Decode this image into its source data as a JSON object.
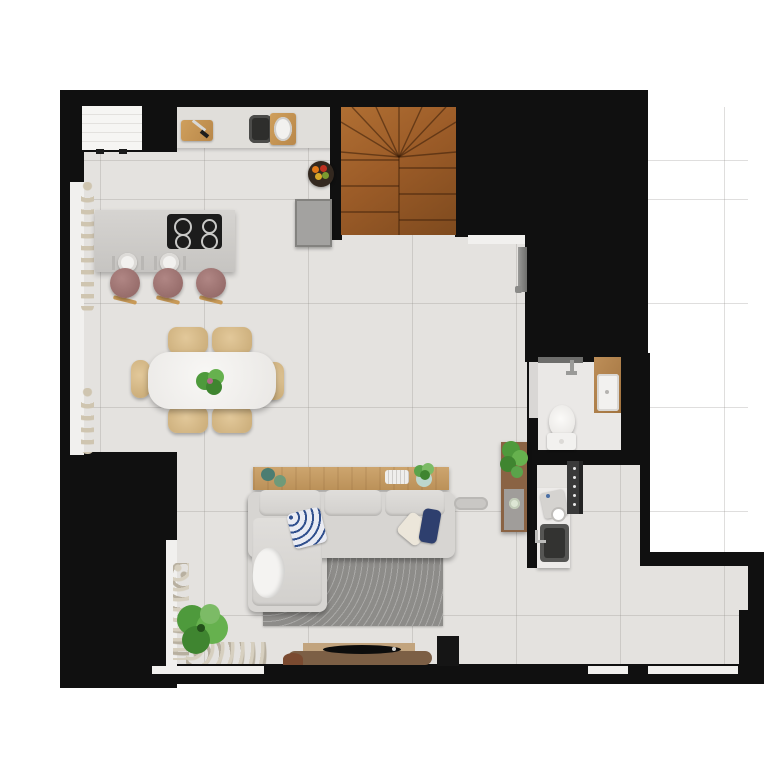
{
  "title": "apartment-floor-plan-top-view",
  "palette": {
    "bg": "#ffffff",
    "wall": "#101010",
    "floor": "#e4e2df",
    "floorBath": "#eae8e6",
    "doorGap": "#d9d7d5",
    "counter": "#e0deda",
    "sill": "#f1f0ee",
    "curtain": "#cfc5b0",
    "brick": "#f6f5f3",
    "cooktop": "#1c1c1c",
    "appliance": "#a3a2a0",
    "basin": "#f2f1ef",
    "sofa": "#d7d5d2",
    "rug": "#8d8c89",
    "pillowBlue": "#31508e",
    "pillowNavy": "#2e3f6e",
    "pebble": "#d6cfbf",
    "woodDark": "#7c5f45",
    "woodSide": "#8a6344",
    "accentBlue": "#4a6fa5",
    "stairsLight": "#b06f33",
    "stairsDark": "#7e4a1e",
    "plantGreen": "#55a143",
    "chairTan": "#d8bc8c",
    "stoolMauve": "#9e7170"
  },
  "scene": {
    "rooms": [
      "kitchen",
      "dining-area",
      "living-room",
      "staircase",
      "bathroom",
      "kitchenette-nook",
      "entry-floor"
    ],
    "kitchen": {
      "items": [
        "white-brick-panel",
        "cutting-board-with-knife",
        "double-sink",
        "fruit-bowl",
        "refrigerator",
        "island-with-cooktop",
        "two-place-settings"
      ],
      "cooktop_burners": 4,
      "bar_stools": 3
    },
    "dining": {
      "table": "white-oval-table",
      "chairs": 6,
      "centerpiece": "green-plant"
    },
    "living": {
      "items": [
        "wood-console-with-decor",
        "l-shaped-sectional-sofa",
        "throw-pillows",
        "throw-blanket",
        "dark-gray-rug",
        "tv-on-wood-bench",
        "black-speaker",
        "floor-plant-with-pebbles"
      ],
      "pillows": [
        "blue-patterned",
        "beige",
        "navy"
      ]
    },
    "bathroom": {
      "items": [
        "shower-fixture",
        "wood-vanity-with-basin",
        "toilet"
      ]
    },
    "kitchenette": {
      "items": [
        "plant-sideboard",
        "espresso-machine",
        "small-sink",
        "dotted-utility-panel"
      ]
    },
    "staircase": {
      "type": "winder-stairs",
      "material": "wood",
      "straight_treads": 7,
      "winder_treads": 8
    },
    "windows": [
      "left-wall-window-with-curtains",
      "bottom-left-corner-window",
      "bottom-wall-windows"
    ]
  }
}
